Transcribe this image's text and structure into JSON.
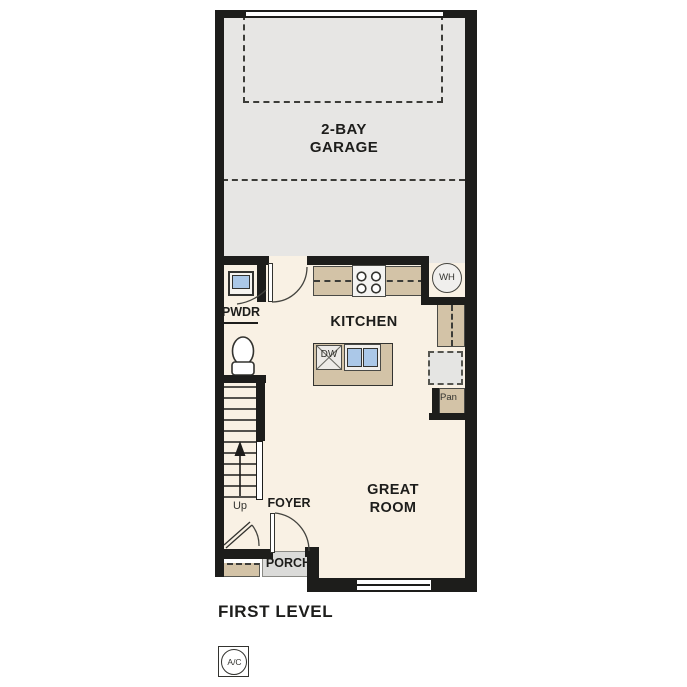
{
  "title": "FIRST LEVEL",
  "colors": {
    "wall": "#1d1d1b",
    "garage_floor": "#e7e6e4",
    "living_floor": "#f9f1e4",
    "counter_tan": "#d3c3a7",
    "fixture_blue": "#abc8e8",
    "porch_gray": "#dbdbd9"
  },
  "rooms": {
    "garage": {
      "label_line1": "2-BAY",
      "label_line2": "GARAGE"
    },
    "kitchen": {
      "label": "KITCHEN"
    },
    "great_room": {
      "label_line1": "GREAT",
      "label_line2": "ROOM"
    },
    "powder": {
      "label": "PWDR"
    },
    "foyer": {
      "label": "FOYER"
    },
    "porch": {
      "label": "PORCH"
    }
  },
  "fixtures": {
    "water_heater": "WH",
    "dishwasher": "DW",
    "pantry": "Pan",
    "stairs_direction": "Up",
    "ac_unit": "A/C"
  }
}
